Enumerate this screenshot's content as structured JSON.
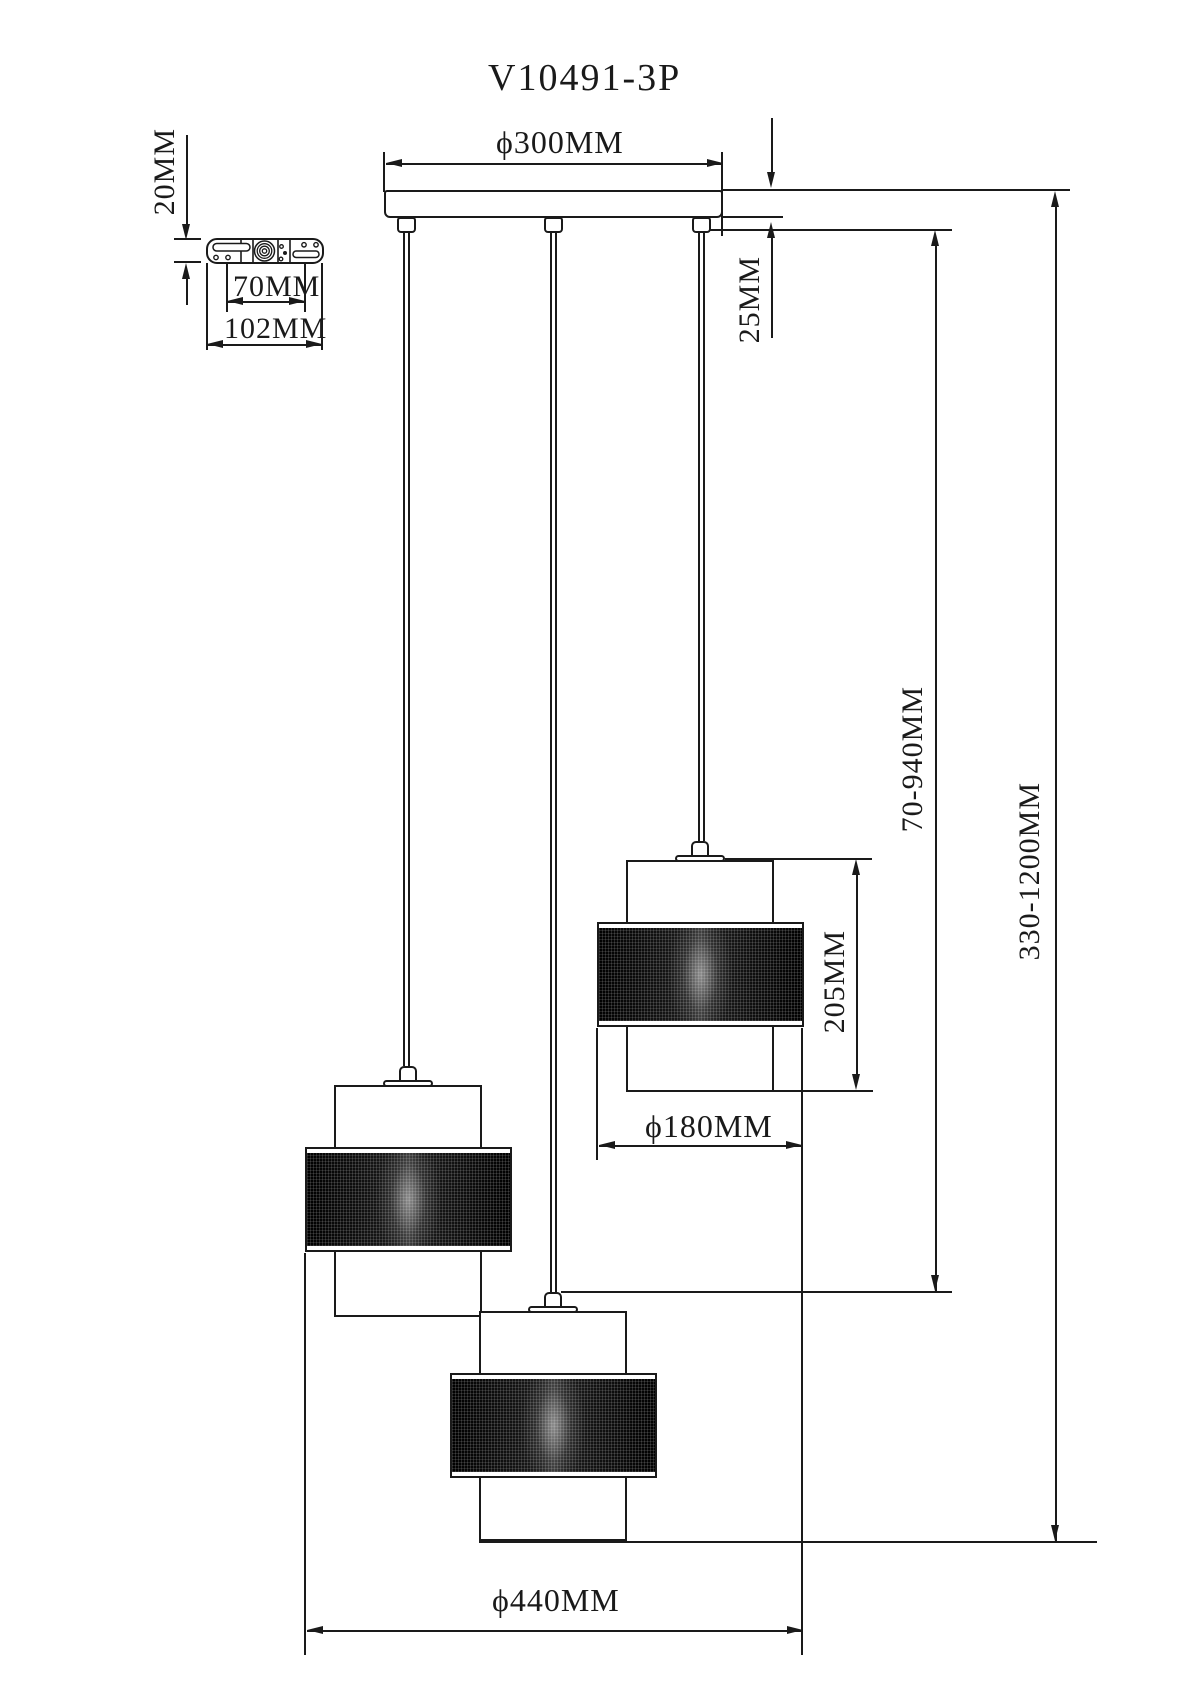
{
  "title": "V10491-3P",
  "dims": {
    "canopy_diameter": "ϕ300MM",
    "canopy_height": "25MM",
    "bracket_thickness": "20MM",
    "bracket_hole_spacing": "70MM",
    "bracket_length": "102MM",
    "cord_adjust_range": "70-940MM",
    "total_height_range": "330-1200MM",
    "shade_height": "205MM",
    "shade_diameter": "ϕ180MM",
    "overall_diameter": "ϕ440MM"
  },
  "colors": {
    "line": "#1a1a1a",
    "background": "#ffffff",
    "shade_fill": "#151515"
  }
}
